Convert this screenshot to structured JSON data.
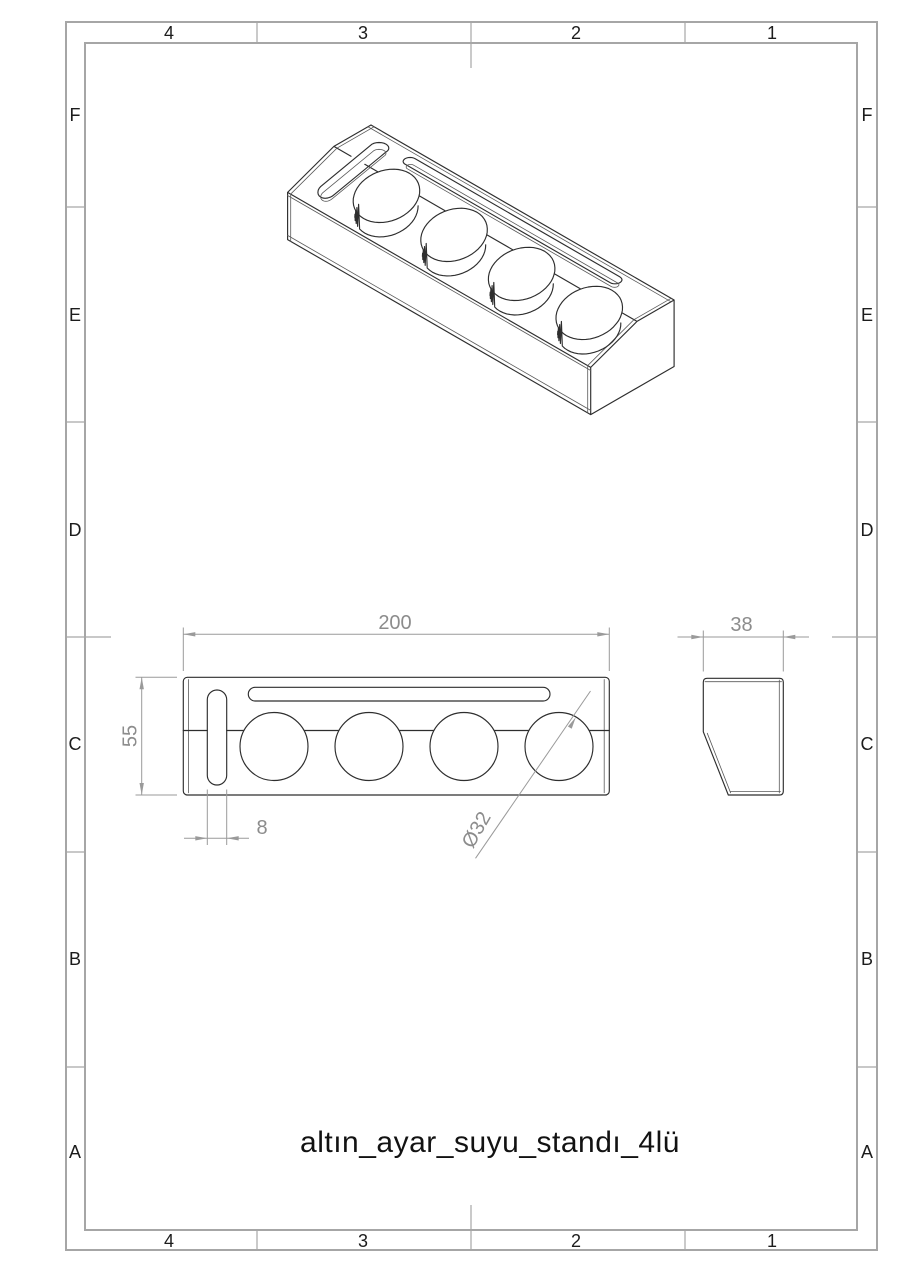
{
  "sheet": {
    "zone_columns": [
      "4",
      "3",
      "2",
      "1"
    ],
    "zone_rows": [
      "F",
      "E",
      "D",
      "C",
      "B",
      "A"
    ]
  },
  "title_block": {
    "part_name": "altın_ayar_suyu_standı_4lü"
  },
  "dimensions": {
    "overall_length": "200",
    "overall_depth": "55",
    "slot_width": "8",
    "hole_diameter": "Ø32",
    "overall_height": "38"
  },
  "views": {
    "isometric": "isometric pictorial view of 4-hole stand",
    "top": "top view with length, depth, slot and hole dimensions",
    "side": "right side profile view with height dimension"
  },
  "colors": {
    "border": "#a6a6a6",
    "model_line": "#2e2e2e",
    "tangent_line": "#5a5a5a",
    "dimension_line": "#9a9a9a",
    "dimension_text": "#8c8c8c",
    "label_text": "#1c1c1c",
    "title_text": "#121212",
    "paper": "#ffffff"
  }
}
